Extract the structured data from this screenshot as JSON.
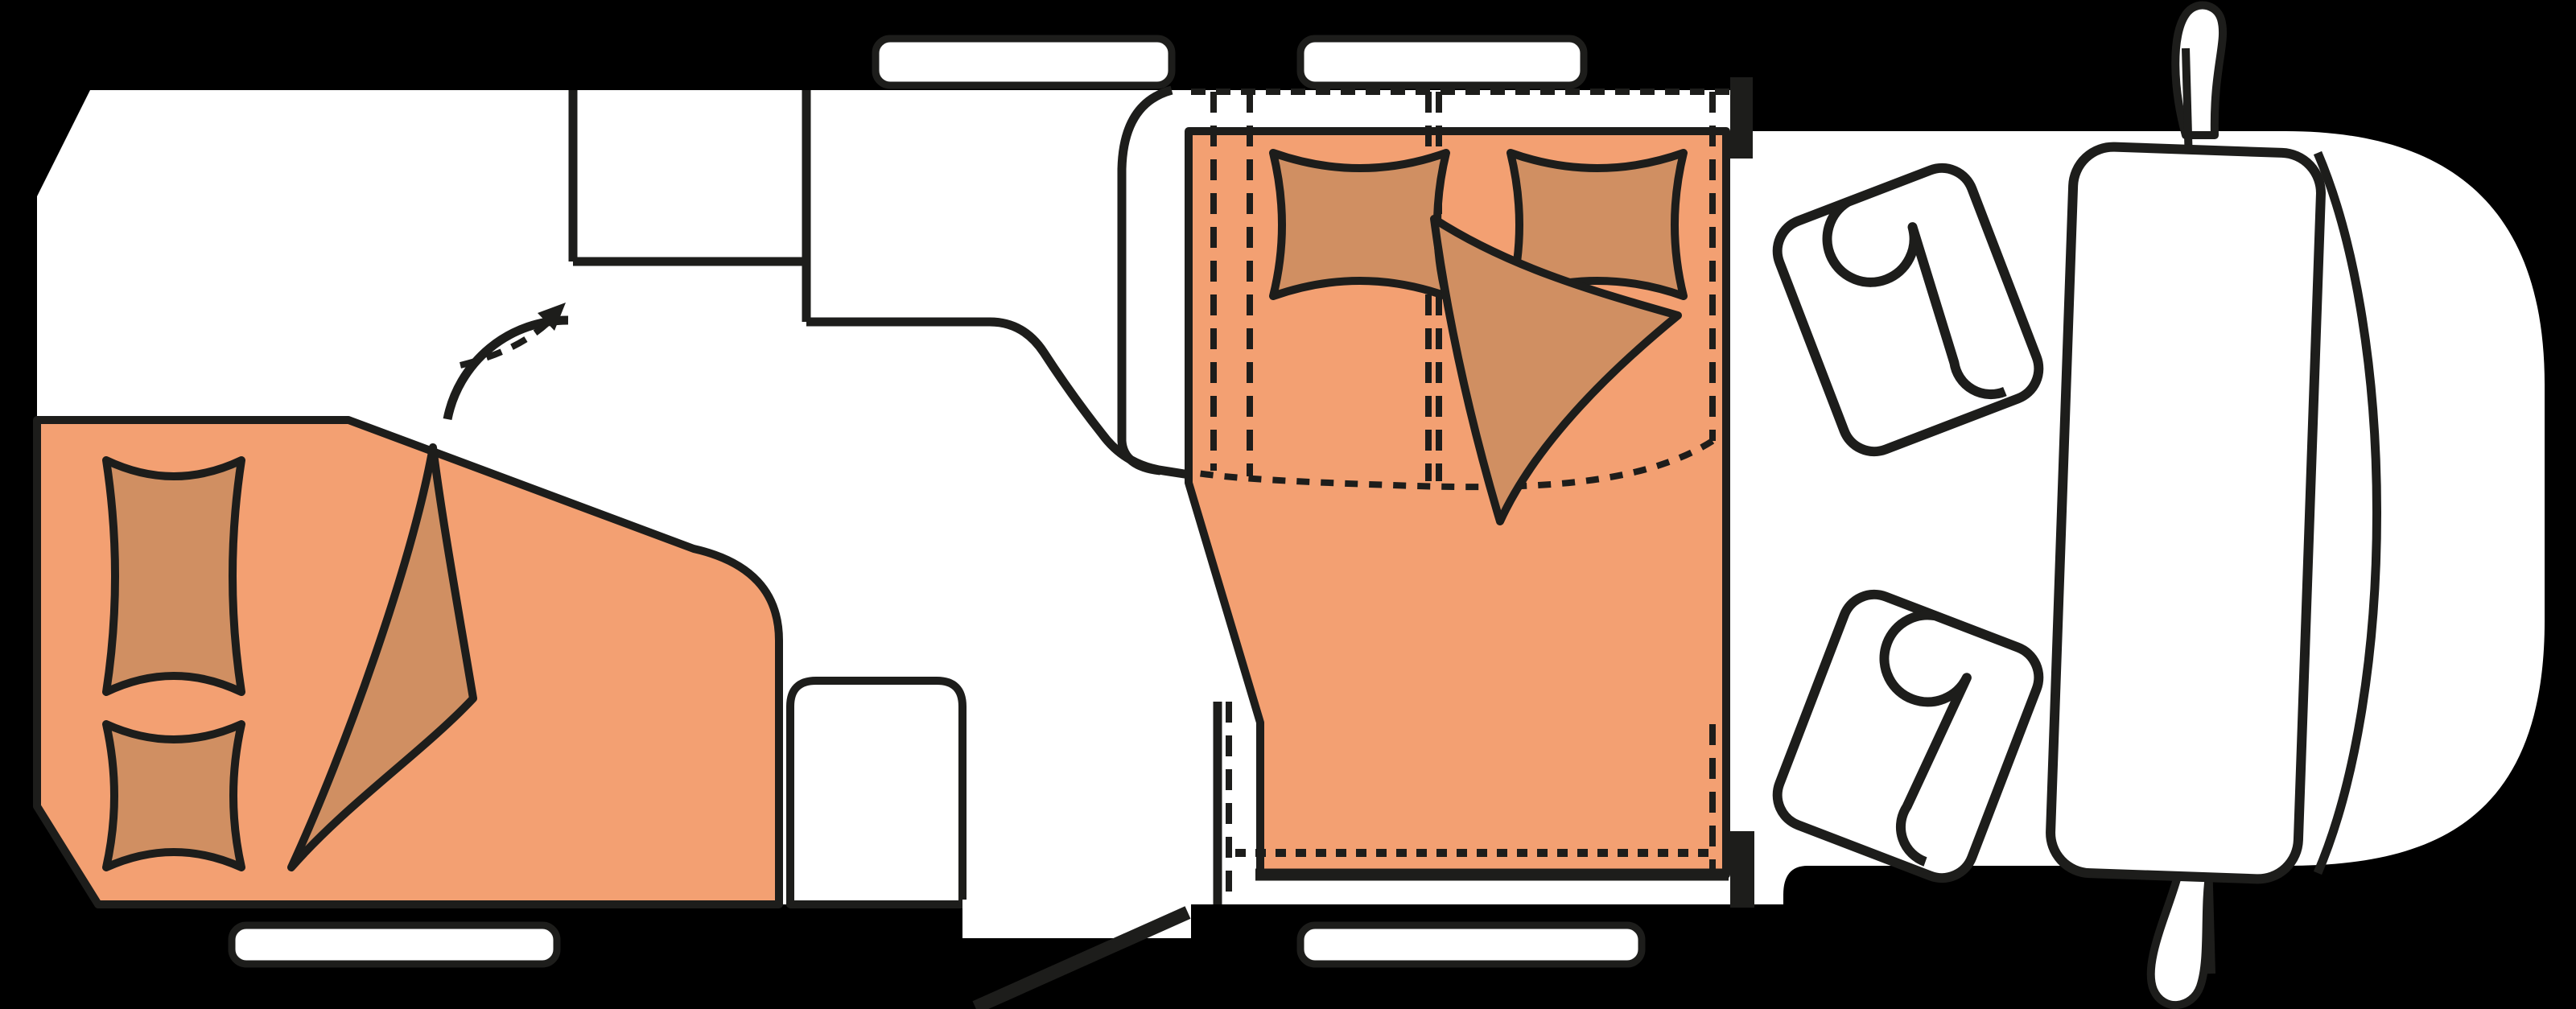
{
  "diagram": {
    "type": "floorplan",
    "subject": "motorhome-top-view",
    "colors": {
      "background": "#000000",
      "line": "#1d1d1b",
      "floor": "#ffffff",
      "bed": "#f3a072",
      "bedding": "#d08f62"
    },
    "counts": {
      "windows": 4,
      "beds": 2,
      "pillows": 4,
      "blankets": 2,
      "cab_seats": 2,
      "mirrors": 2,
      "doors": 1
    },
    "elements": {
      "rear_bed": "rear double bed with two pillows and folded blanket",
      "drop_down_bed": "drop-down bed with dashed raised-position outline",
      "bathroom": "rear washroom with pivoting wall swing arrow",
      "kitchen": "kitchen block with curved counter wall",
      "entry_door": "open entry door at bottom side wall",
      "cab": "driver cab with two rotated seats, dashboard, windshield, side mirrors"
    }
  }
}
